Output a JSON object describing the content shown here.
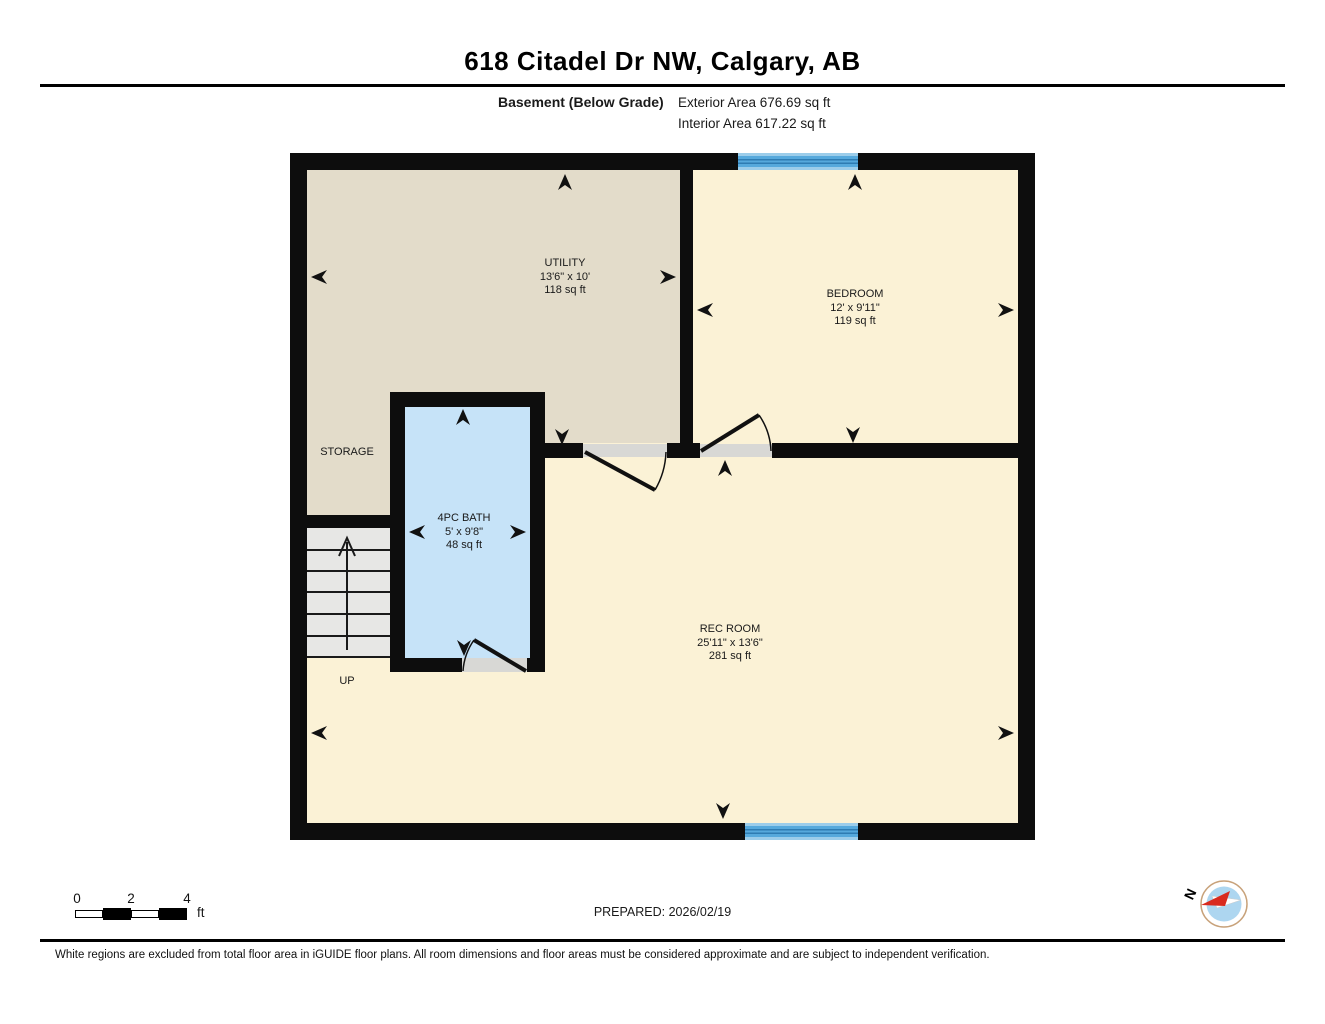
{
  "header": {
    "title": "618 Citadel Dr NW, Calgary, AB",
    "floor_label": "Basement (Below Grade)",
    "exterior_area": "Exterior Area 676.69 sq ft",
    "interior_area": "Interior Area 617.22 sq ft"
  },
  "rooms": {
    "utility": {
      "name": "UTILITY",
      "dims": "13'6\" x 10'",
      "area": "118 sq ft"
    },
    "bedroom": {
      "name": "BEDROOM",
      "dims": "12' x 9'11\"",
      "area": "119 sq ft"
    },
    "bath": {
      "name": "4PC BATH",
      "dims": "5' x 9'8\"",
      "area": "48 sq ft"
    },
    "rec_room": {
      "name": "REC ROOM",
      "dims": "25'11\" x 13'6\"",
      "area": "281 sq ft"
    },
    "storage_label": "STORAGE",
    "up_label": "UP"
  },
  "scale_bar": {
    "ticks": [
      "0",
      "2",
      "4"
    ],
    "unit": "ft"
  },
  "footer": {
    "prepared": "PREPARED: 2026/02/19",
    "disclaimer": "White regions are excluded from total floor area in iGUIDE floor plans. All room dimensions and floor areas must be considered approximate and are subject to independent verification."
  },
  "compass": {
    "north_label": "N"
  },
  "colors": {
    "room_fill_yellow": "#FBF2D6",
    "room_fill_tan": "#E3DCCA",
    "bath_fill_blue": "#C6E3F8",
    "window_blue": "#56A9DC",
    "wall_black": "#0D0D0D",
    "stairs_gray": "#E7E7E5"
  }
}
